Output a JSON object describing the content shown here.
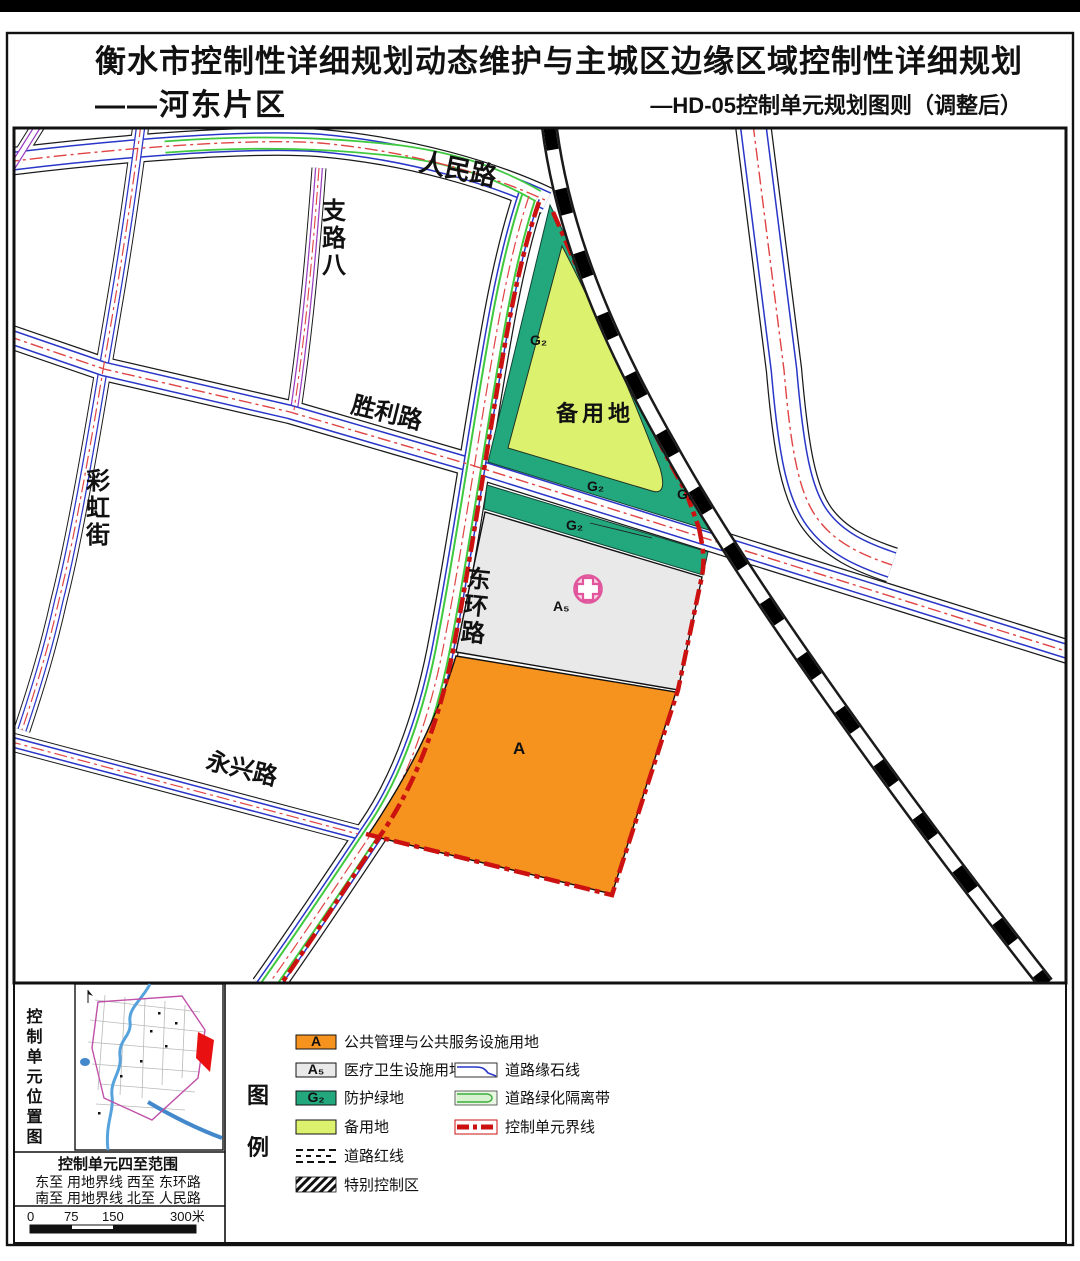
{
  "page": {
    "title_line1": "衡水市控制性详细规划动态维护与主城区边缘区域控制性详细规划",
    "district": "——河东片区",
    "sheet_label": "—HD-05控制单元规划图则（调整后）"
  },
  "map": {
    "road_labels": {
      "renmin": "人民路",
      "zhiluba": "支路八",
      "shengli": "胜利路",
      "caihong": "彩虹街",
      "donghuan": "东环路",
      "yongxing": "永兴路"
    },
    "zone_labels": {
      "reserve": "备用地",
      "g2": "G₂",
      "a5": "A₅",
      "a": "A"
    }
  },
  "locator": {
    "title": "控制单元位置图"
  },
  "extent": {
    "title": "控制单元四至范围",
    "row1": "东至  用地界线   西至  东环路",
    "row2": "南至  用地界线   北至  人民路"
  },
  "scalebar": {
    "t0": "0",
    "t75": "75",
    "t150": "150",
    "t300": "300米"
  },
  "legend": {
    "tu": "图",
    "li": "例",
    "items": [
      {
        "code": "A",
        "label": "公共管理与公共服务设施用地"
      },
      {
        "code": "A₅",
        "label": "医疗卫生设施用地"
      },
      {
        "code": "G₂",
        "label": "防护绿地"
      },
      {
        "code": "",
        "label": "备用地"
      },
      {
        "code": "",
        "label": "道路红线"
      },
      {
        "code": "",
        "label": "特别控制区"
      }
    ],
    "line_items": [
      {
        "label": "道路缘石线"
      },
      {
        "label": "道路绿化隔离带"
      },
      {
        "label": "控制单元界线"
      }
    ]
  },
  "colors": {
    "public_service_orange": "#f6921e",
    "medical_gray": "#e9e9e9",
    "protective_green": "#23a87d",
    "reserve_yellowgreen": "#dcf26e",
    "boundary_red": "#cc1111",
    "centerline_red": "#e04444",
    "curb_blue": "#2936c8",
    "minor_road_purple": "#9a3fc0",
    "green_belt": "#3fc93f",
    "railway_black": "#000000",
    "hospital_pink": "#e0559b"
  }
}
